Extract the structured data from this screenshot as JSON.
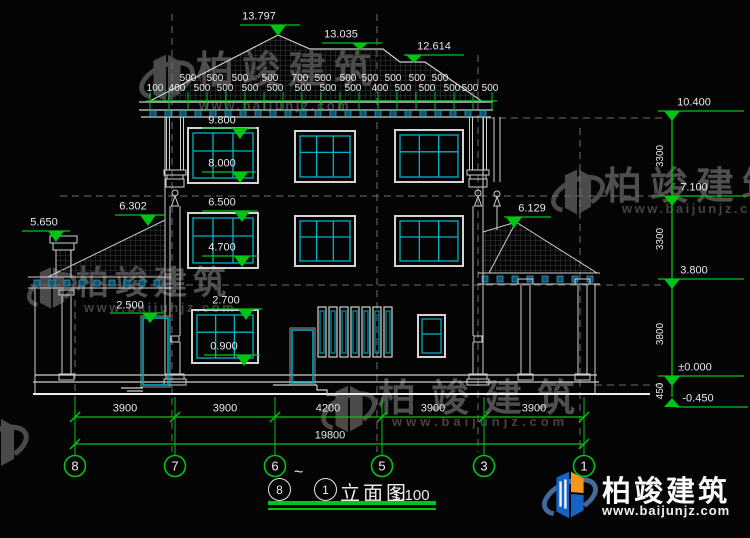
{
  "watermark": {
    "brand": "柏竣建筑",
    "url": "www.baijunjz.com"
  },
  "logo": {
    "brand": "柏竣建筑",
    "url": "www.baijunjz.com"
  },
  "title": {
    "from": "8",
    "tilde": "~",
    "to": "1",
    "name": "立面图",
    "scale": "1:100"
  },
  "levels": {
    "roof_peak": "13.797",
    "roof_mid": "13.035",
    "roof_low": "12.614",
    "eave": "9.800",
    "f3_sill": "8.000",
    "f2_top": "6.500",
    "f2_sill": "4.700",
    "f1_top": "2.700",
    "f1_sill": "0.900",
    "left_roof": "6.302",
    "chimney": "5.650",
    "left_door": "2.500",
    "right_roof": "6.129",
    "ridge_right": "10.400",
    "f2_right": "7.100",
    "f1_right": "3.800",
    "zero": "±0.000",
    "ground": "-0.450"
  },
  "right_segments": [
    "3300",
    "3300",
    "3800",
    "450"
  ],
  "eave_dims": {
    "row1": [
      "500",
      "500",
      "500",
      "500",
      "700",
      "500",
      "500",
      "500",
      "500",
      "500",
      "500"
    ],
    "row2": [
      "100",
      "400",
      "500",
      "500",
      "500",
      "500",
      "500",
      "500",
      "500",
      "400",
      "500",
      "500",
      "500",
      "500",
      "500"
    ]
  },
  "bottom_dims": {
    "segments": [
      "3900",
      "3900",
      "4200",
      "3900",
      "3900"
    ],
    "total": "19800"
  },
  "axes": [
    "8",
    "7",
    "6",
    "5",
    "3",
    "1"
  ]
}
